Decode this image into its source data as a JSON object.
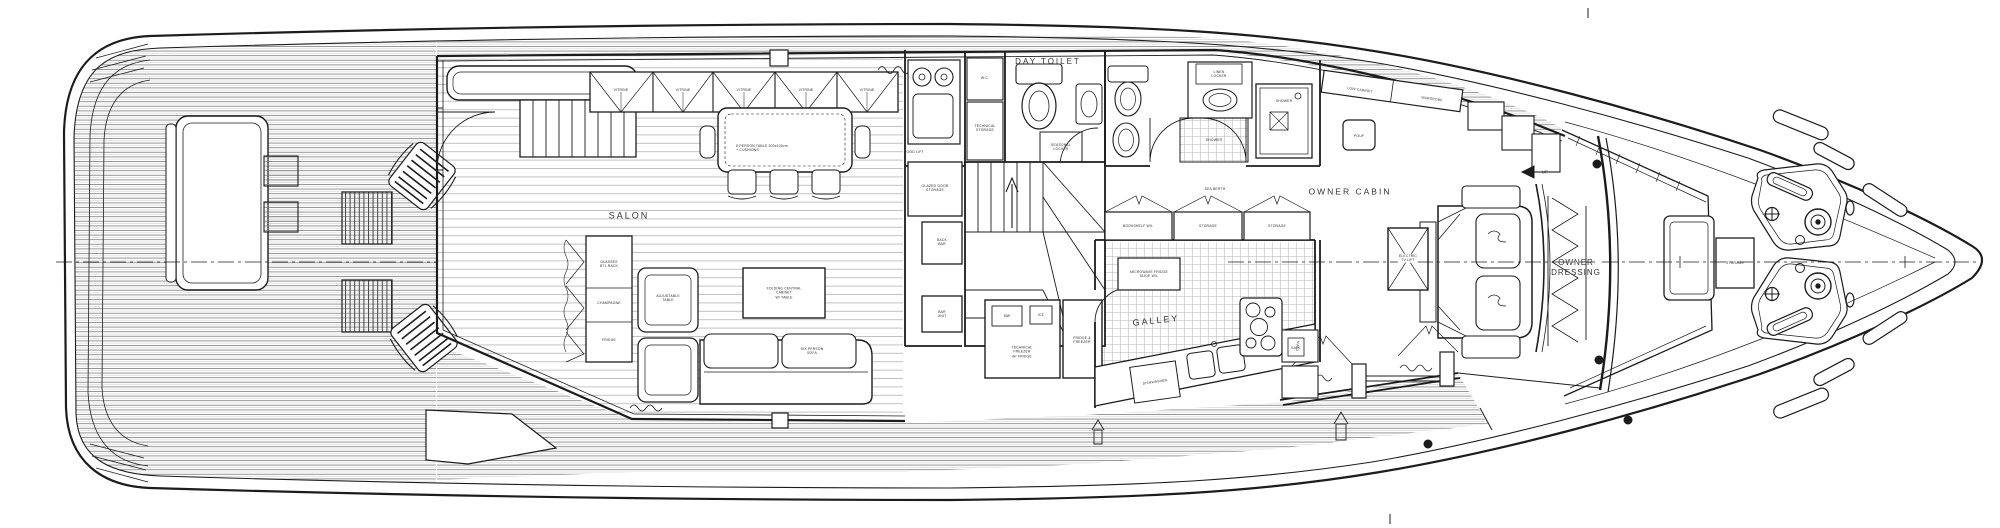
{
  "title": "Motor yacht main deck floor plan",
  "ink_color": "#1c1c1c",
  "teak_color": "#8a8a8a",
  "labels": {
    "salon": "SALON",
    "day_toilet": "DAY TOILET",
    "galley": "GALLEY",
    "owner_cabin": "OWNER CABIN",
    "owner_dressing": "OWNER\nDRESSING",
    "storage_bow": "STORAGE",
    "table_spec": "8 PERSON TABLE 300x100cm\n+ CUSHIONS",
    "vitrine": "VITRINE",
    "glasses": "GLASSES\nBTL RACK",
    "champagne": "CHAMPAGNE",
    "fridge": "FRIDGE",
    "adjustable_table": "ADJUSTABLE\nTABLE",
    "folding_cabinet": "FOLDING CENTRAL\nCABINET\nW/ TABLE",
    "sofa": "SIX PERSON\nSOFA",
    "food_lift": "FOOD LIFT",
    "wc": "W.C.",
    "technical_storage": "TECHNICAL\nSTORAGE",
    "seasonal_locker": "SEASONAL\nLOCKER",
    "glazed_storage": "GLAZED DOOR\nSTORAGE",
    "back_bar": "BACK\nBAR",
    "bar_unit": "BAR\nUNIT",
    "mw": "MW",
    "ice": "ICE",
    "technical_fridge": "TECHNICAL\nFREEZER\nW/ FRIDGE",
    "fridge_freezer": "FRIDGE &\nFREEZER",
    "sea_berth": "SEA BERTH",
    "bookshelf": "BOOKSHELF W/L",
    "storage_sm": "STORAGE",
    "microwave_fridge": "MICROWAVE FRIDGE\nSLIDE W/L",
    "dishwasher": "DISHWASHER",
    "oven": "OVEN",
    "shower": "SHOWER",
    "linen_locker": "LINEN\nLOCKER",
    "low_cabinet": "LOW CABINET",
    "wardrobe": "WARDROBE",
    "pouf": "POUF",
    "tv_lift": "ELECTRIC\nTV LIFT",
    "safe": "SAFE",
    "up": "UP"
  }
}
